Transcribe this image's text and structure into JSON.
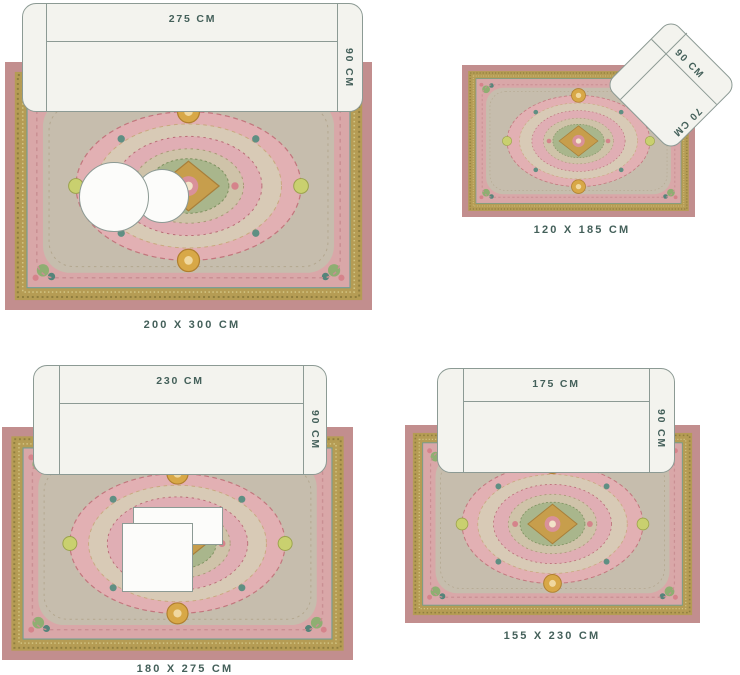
{
  "colors": {
    "label-text": "#44605a",
    "furniture-fill": "#f3f3ee",
    "furniture-stroke": "#8c9a94",
    "table-fill": "#fcfcfa",
    "rug-outer": "#c28e8e",
    "rug-border-gold": "#b59c54",
    "rug-margin-pink": "#d9a7a8",
    "rug-field": "#c6bdad",
    "rug-medallion-pink": "#e2b0b3",
    "rug-medallion-cream": "#d8cab6",
    "rug-medallion-sage": "#a9b68c",
    "rug-medallion-gold": "#c79e4c",
    "rug-accent-teal": "#5f8f83"
  },
  "groups": [
    {
      "id": "rug-200x300",
      "caption": "200 X 300 CM",
      "furniture": {
        "type": "sofa",
        "width_label": "275 CM",
        "depth_label": "90 CM"
      },
      "tables": {
        "type": "round",
        "count": 2
      }
    },
    {
      "id": "rug-120x185",
      "caption": "120 X 185 CM",
      "furniture": {
        "type": "armchair",
        "width_label": "90 CM",
        "depth_label": "70 CM"
      }
    },
    {
      "id": "rug-180x275",
      "caption": "180 X 275 CM",
      "furniture": {
        "type": "sofa",
        "width_label": "230 CM",
        "depth_label": "90 CM"
      },
      "tables": {
        "type": "square",
        "count": 2
      }
    },
    {
      "id": "rug-155x230",
      "caption": "155 X 230 CM",
      "furniture": {
        "type": "sofa",
        "width_label": "175 CM",
        "depth_label": "90 CM"
      }
    }
  ]
}
